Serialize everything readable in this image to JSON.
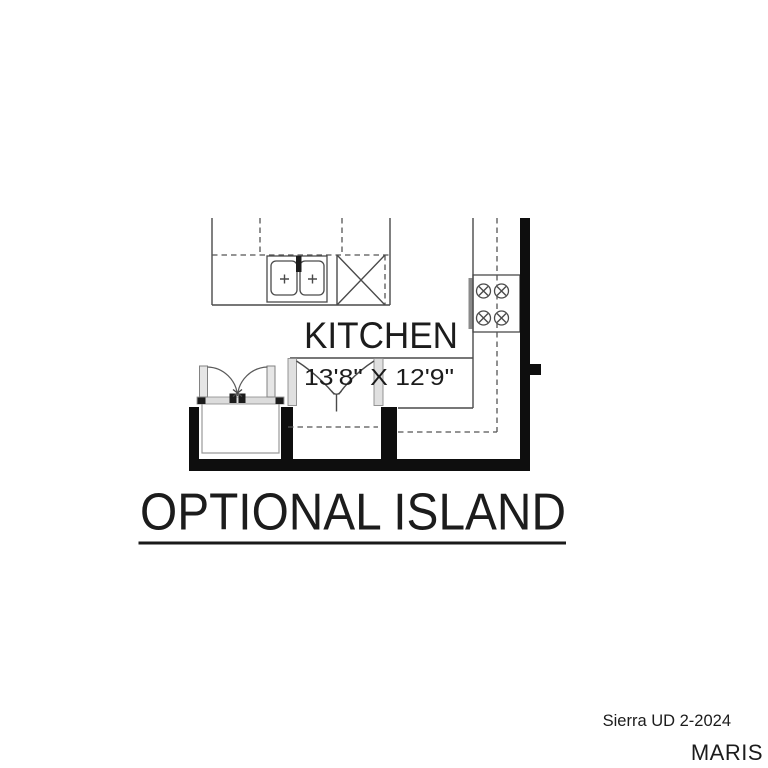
{
  "plan": {
    "room_label": "KITCHEN",
    "room_dimensions": "13'8\" X 12'9\"",
    "caption": "OPTIONAL ISLAND",
    "fixtures": [
      "double-sink",
      "dishwasher",
      "range-cooktop",
      "double-doors",
      "bifold-closet-doors",
      "upper-cabinets-dashed"
    ]
  },
  "watermark": {
    "listing_code": "Sierra UD 2-2024",
    "brand": "MARIS"
  },
  "colors": {
    "background": "#ffffff",
    "wall": "#0e0e0e",
    "line": "#4a4a4a",
    "caption_text": "#2b2b2b",
    "brand_watermark_gray": "#bdbdbd"
  }
}
